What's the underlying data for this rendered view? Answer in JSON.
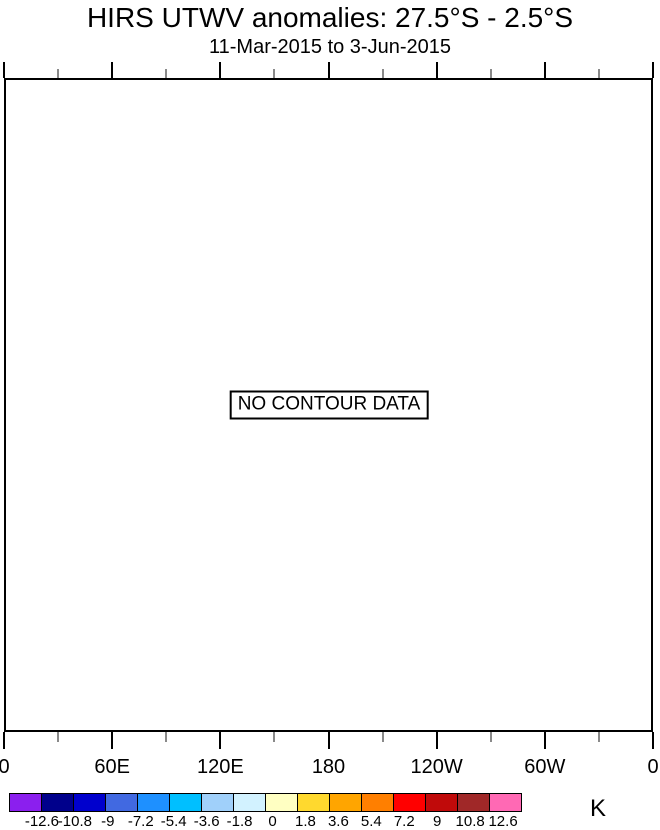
{
  "title": "HIRS UTWV anomalies: 27.5°S - 2.5°S",
  "subtitle": "11-Mar-2015 to 3-Jun-2015",
  "plot": {
    "no_data_label": "NO CONTOUR DATA",
    "x_axis": {
      "tick_labels": [
        "0",
        "60E",
        "120E",
        "180",
        "120W",
        "60W",
        "0"
      ],
      "minor_ticks_per_interval": 1,
      "minor_tick_color": "#8a8a8a",
      "major_tick_color": "#000000"
    }
  },
  "colorbar": {
    "unit_label": "K",
    "boundary_labels": [
      "-12.6",
      "-10.8",
      "-9",
      "-7.2",
      "-5.4",
      "-3.6",
      "-1.8",
      "0",
      "1.8",
      "3.6",
      "5.4",
      "7.2",
      "9",
      "10.8",
      "12.6"
    ],
    "colors": [
      "#8b1fee",
      "#00008b",
      "#0000cd",
      "#4169e1",
      "#1e90ff",
      "#00bfff",
      "#a0d0fa",
      "#d2f2ff",
      "#ffffc2",
      "#ffd92e",
      "#ffa500",
      "#ff7f00",
      "#ff0000",
      "#c00a0a",
      "#a02828",
      "#ff69b4"
    ]
  },
  "chart_data": {
    "type": "heatmap",
    "title": "HIRS UTWV anomalies: 27.5°S - 2.5°S",
    "subtitle": "11-Mar-2015 to 3-Jun-2015",
    "x_tick_labels": [
      "0",
      "60E",
      "120E",
      "180",
      "120W",
      "60W",
      "0"
    ],
    "x_range_degrees": [
      0,
      360
    ],
    "values": [],
    "no_data_message": "NO CONTOUR DATA",
    "grid": false,
    "colorbar": {
      "unit": "K",
      "position": "bottom",
      "levels": [
        -12.6,
        -10.8,
        -9,
        -7.2,
        -5.4,
        -3.6,
        -1.8,
        0,
        1.8,
        3.6,
        5.4,
        7.2,
        9,
        10.8,
        12.6
      ],
      "colors": [
        "#8b1fee",
        "#00008b",
        "#0000cd",
        "#4169e1",
        "#1e90ff",
        "#00bfff",
        "#a0d0fa",
        "#d2f2ff",
        "#ffffc2",
        "#ffd92e",
        "#ffa500",
        "#ff7f00",
        "#ff0000",
        "#c00a0a",
        "#a02828",
        "#ff69b4"
      ]
    }
  }
}
